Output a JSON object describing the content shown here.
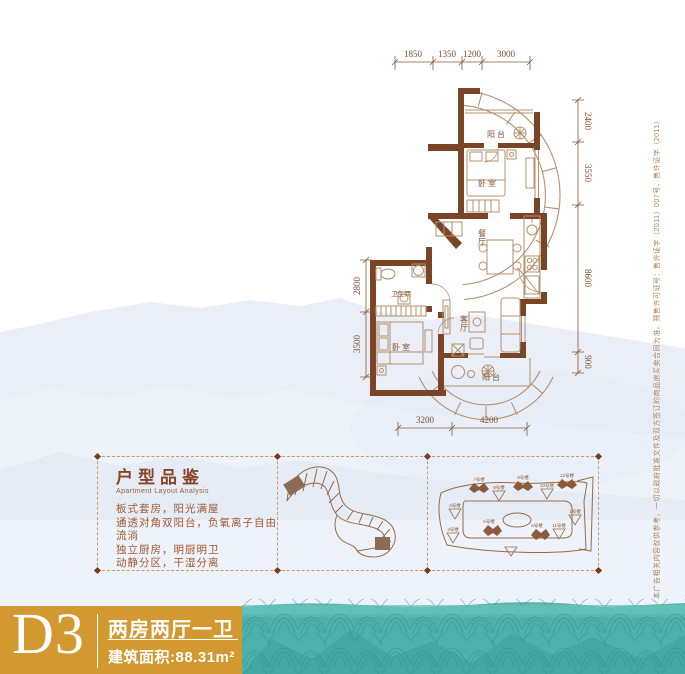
{
  "floor_plan": {
    "dims_top": [
      "1850",
      "1350",
      "1200",
      "3000"
    ],
    "dims_right": [
      "2400",
      "3550",
      "8600",
      "900"
    ],
    "dims_left": [
      "2800",
      "3500"
    ],
    "dims_bottom": [
      "3200",
      "4200"
    ],
    "rooms": {
      "balcony_top": "阳台",
      "bedroom_top": "卧室",
      "dining": "餐厅",
      "bathroom": "卫生间",
      "living": "客厅",
      "bedroom_bottom": "卧室",
      "balcony_bottom": "阳台"
    }
  },
  "analysis": {
    "title": "户型品鉴",
    "subtitle": "Apartment Layout Analysis",
    "lines": [
      "板式套房，阳光满屋",
      "通透对角双阳台，负氧离子自由流淌",
      "独立厨房，明厨明卫",
      "动静分区，干湿分离"
    ]
  },
  "site_plan": {
    "labels": [
      "7号楼",
      "8号楼",
      "9号楼",
      "10号楼",
      "12号楼",
      "2号楼",
      "3号楼",
      "5号楼",
      "6号楼",
      "1号楼",
      "11号楼"
    ]
  },
  "banner": {
    "unit_code": "D3",
    "layout_type": "两房两厅一卫",
    "area": "建筑面积:88.31m²"
  },
  "disclaimer": "本广告相关内容仅供参考，一切以政府批准文件及双方签订的商品房买卖合同为准。预售许可证号：售许证字（2011）007号、售许证字（2011）014号",
  "colors": {
    "accent_orange": "#d3982f",
    "wall_brown": "#7a4526",
    "teal": "#54b6af",
    "text_brown": "#8a4f2d"
  }
}
